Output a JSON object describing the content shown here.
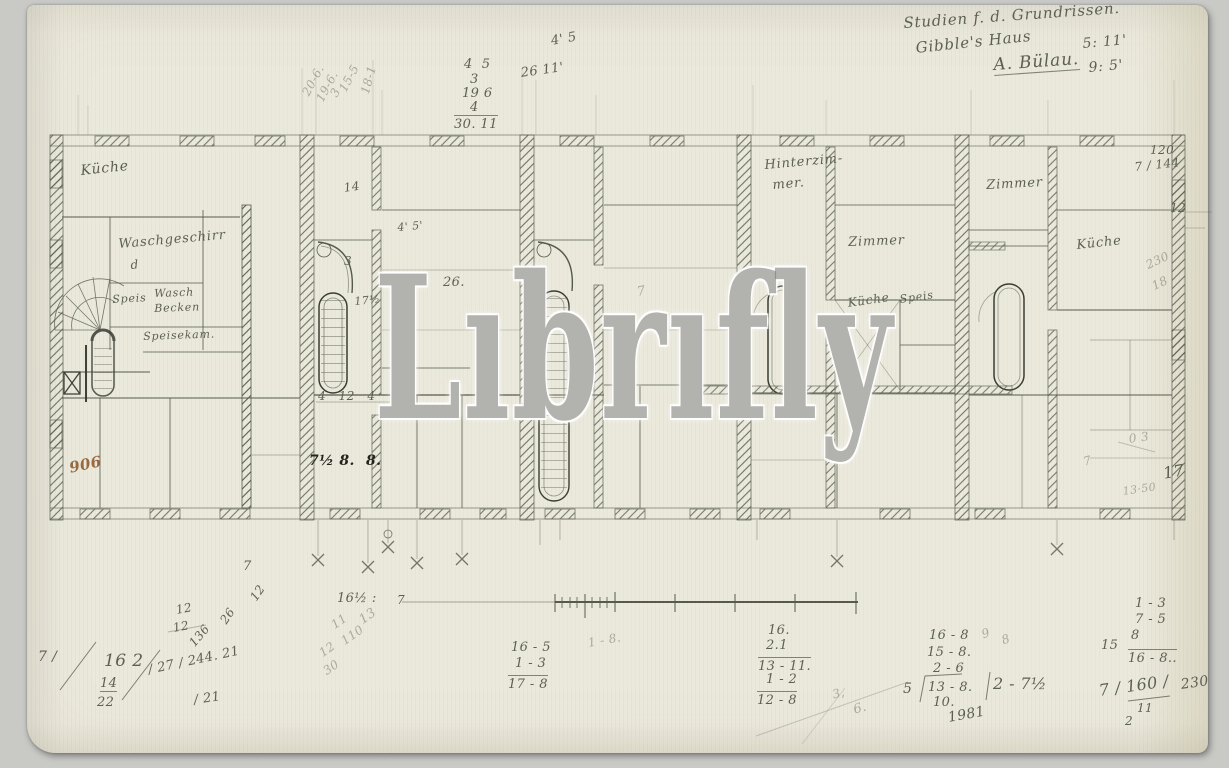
{
  "watermark": {
    "text": "Lıbrıfly"
  },
  "colors": {
    "paper": "#ebe9dc",
    "background": "#c9c9c6",
    "pencil": "#5c6053",
    "dark_ink": "#24241c",
    "sepia_ink": "#8a5426",
    "watermark_gray": "#7a7a75"
  },
  "title_block": {
    "line1": "Studien f. d. Grundrissen.",
    "line2": "Gibble's Haus",
    "dimension_a": "5: 11'",
    "signature": "A. Bülau.",
    "dimension_b": "9: 5'"
  },
  "annotations": [
    {
      "t": "Studien f. d. Grundrissen.",
      "x": 903,
      "y": 16,
      "r": -4,
      "s": 15,
      "c": "script",
      "n": "title-line1"
    },
    {
      "t": "Gibble's Haus",
      "x": 915,
      "y": 41,
      "r": -6,
      "s": 15,
      "c": "script",
      "n": "title-line2"
    },
    {
      "t": "5: 11'",
      "x": 1082,
      "y": 37,
      "r": -5,
      "s": 14,
      "c": "script",
      "n": "title-dimension-a"
    },
    {
      "t": "A. Bülau.",
      "x": 993,
      "y": 57,
      "r": -4,
      "s": 17,
      "c": "script underline",
      "n": "title-signature"
    },
    {
      "t": "9: 5'",
      "x": 1088,
      "y": 61,
      "r": -5,
      "s": 14,
      "c": "script",
      "n": "title-dimension-b"
    },
    {
      "t": "20-6.",
      "x": 300,
      "y": 92,
      "r": -62,
      "s": 12,
      "c": "faint",
      "n": "calc-top-left"
    },
    {
      "t": "19-6.",
      "x": 314,
      "y": 98,
      "r": -62,
      "s": 12,
      "c": "faint"
    },
    {
      "t": "3",
      "x": 328,
      "y": 93,
      "r": -62,
      "s": 12,
      "c": "faint"
    },
    {
      "t": "15-5",
      "x": 337,
      "y": 88,
      "r": -62,
      "s": 12,
      "c": "faint"
    },
    {
      "t": "18-1",
      "x": 359,
      "y": 92,
      "r": -75,
      "s": 12,
      "c": "faint"
    },
    {
      "t": "4  5",
      "x": 464,
      "y": 58,
      "s": 13,
      "n": "calc-top-middle"
    },
    {
      "t": "3",
      "x": 470,
      "y": 73,
      "s": 13
    },
    {
      "t": "19 6",
      "x": 462,
      "y": 87,
      "s": 13
    },
    {
      "t": "4",
      "x": 470,
      "y": 101,
      "s": 13
    },
    {
      "t": "30. 11",
      "x": 454,
      "y": 115,
      "s": 13,
      "c": "sum"
    },
    {
      "t": "26 11'",
      "x": 520,
      "y": 67,
      "r": -8,
      "s": 13
    },
    {
      "t": "4' 5",
      "x": 550,
      "y": 35,
      "r": -10,
      "s": 13
    },
    {
      "t": "Küche",
      "x": 80,
      "y": 164,
      "r": -6,
      "s": 14,
      "c": "script",
      "n": "room-label-kueche-1"
    },
    {
      "t": "Waschgeschirr",
      "x": 118,
      "y": 238,
      "r": -5,
      "s": 13,
      "c": "script",
      "n": "room-label-waschgeschirr"
    },
    {
      "t": "d",
      "x": 130,
      "y": 259,
      "r": -5,
      "s": 12,
      "c": "script"
    },
    {
      "t": "Speis",
      "x": 112,
      "y": 294,
      "r": -3,
      "s": 11,
      "c": "script",
      "n": "room-label-speis-1"
    },
    {
      "t": "Wasch",
      "x": 154,
      "y": 288,
      "r": -2,
      "s": 11,
      "c": "script",
      "n": "room-label-wasch"
    },
    {
      "t": "Becken",
      "x": 154,
      "y": 303,
      "r": -2,
      "s": 11,
      "c": "script"
    },
    {
      "t": "Speisekam.",
      "x": 143,
      "y": 331,
      "r": -2,
      "s": 11,
      "c": "script",
      "n": "room-label-speisekammer"
    },
    {
      "t": "906",
      "x": 68,
      "y": 461,
      "r": -12,
      "s": 15,
      "c": "sepia",
      "n": "number-sepia-906"
    },
    {
      "t": "14",
      "x": 343,
      "y": 182,
      "r": -8,
      "s": 12
    },
    {
      "t": "4' 5'",
      "x": 397,
      "y": 222,
      "r": -5,
      "s": 11
    },
    {
      "t": "3",
      "x": 344,
      "y": 255,
      "s": 12
    },
    {
      "t": "26.",
      "x": 443,
      "y": 276,
      "s": 13
    },
    {
      "t": "17½",
      "x": 354,
      "y": 296,
      "r": -5,
      "s": 11
    },
    {
      "t": "6½",
      "x": 395,
      "y": 357,
      "r": -3,
      "s": 11
    },
    {
      "t": "4   12   4",
      "x": 318,
      "y": 390,
      "s": 12
    },
    {
      "t": "7½ 8.",
      "x": 309,
      "y": 454,
      "s": 14,
      "c": "ink",
      "n": "dim-ink-1"
    },
    {
      "t": "8.",
      "x": 366,
      "y": 454,
      "s": 14,
      "c": "ink",
      "n": "dim-ink-2"
    },
    {
      "t": "7",
      "x": 636,
      "y": 286,
      "r": -10,
      "s": 13,
      "c": "faint"
    },
    {
      "t": "Hinterzim-",
      "x": 764,
      "y": 159,
      "r": -5,
      "s": 13,
      "c": "script",
      "n": "room-label-hinterzimmer"
    },
    {
      "t": "mer.",
      "x": 772,
      "y": 179,
      "r": -5,
      "s": 13,
      "c": "script"
    },
    {
      "t": "Zimmer",
      "x": 848,
      "y": 236,
      "r": -2,
      "s": 13,
      "c": "script",
      "n": "room-label-zimmer-1"
    },
    {
      "t": "Küche",
      "x": 847,
      "y": 297,
      "r": -8,
      "s": 12,
      "c": "script",
      "n": "room-label-kueche-2"
    },
    {
      "t": "Speis",
      "x": 899,
      "y": 294,
      "r": -8,
      "s": 11,
      "c": "script",
      "n": "room-label-speis-2"
    },
    {
      "t": "Zimmer",
      "x": 986,
      "y": 179,
      "r": -3,
      "s": 13,
      "c": "script",
      "n": "room-label-zimmer-2"
    },
    {
      "t": "Küche",
      "x": 1076,
      "y": 239,
      "r": -6,
      "s": 13,
      "c": "script",
      "n": "room-label-kueche-3"
    },
    {
      "t": "120",
      "x": 1150,
      "y": 144,
      "s": 12,
      "n": "margin-number"
    },
    {
      "t": "7 / 144",
      "x": 1134,
      "y": 161,
      "r": -6,
      "s": 12
    },
    {
      "t": "12",
      "x": 1170,
      "y": 202,
      "s": 12
    },
    {
      "t": "230",
      "x": 1144,
      "y": 260,
      "r": -25,
      "s": 12,
      "c": "faint"
    },
    {
      "t": "18",
      "x": 1150,
      "y": 281,
      "r": -25,
      "s": 12,
      "c": "faint"
    },
    {
      "t": "0 3",
      "x": 1128,
      "y": 433,
      "r": -8,
      "s": 12,
      "c": "faint"
    },
    {
      "t": "7",
      "x": 1082,
      "y": 456,
      "r": -15,
      "s": 12,
      "c": "faint"
    },
    {
      "t": "17",
      "x": 1162,
      "y": 466,
      "r": -10,
      "s": 16
    },
    {
      "t": "13·50",
      "x": 1122,
      "y": 486,
      "r": -8,
      "s": 11,
      "c": "faint"
    },
    {
      "t": "7",
      "x": 243,
      "y": 560,
      "s": 13
    },
    {
      "t": "12",
      "x": 248,
      "y": 596,
      "r": -55,
      "s": 12
    },
    {
      "t": "12",
      "x": 175,
      "y": 604,
      "r": -10,
      "s": 12
    },
    {
      "t": "12",
      "x": 172,
      "y": 622,
      "r": -10,
      "s": 12
    },
    {
      "t": "26",
      "x": 218,
      "y": 619,
      "r": -55,
      "s": 12
    },
    {
      "t": "136",
      "x": 187,
      "y": 641,
      "r": -50,
      "s": 12
    },
    {
      "t": "7 /",
      "x": 38,
      "y": 650,
      "s": 14
    },
    {
      "t": "16 2",
      "x": 104,
      "y": 653,
      "s": 17,
      "n": "calc-bottom-left"
    },
    {
      "t": "/ 27 / 244. 21",
      "x": 147,
      "y": 664,
      "r": -12,
      "s": 13
    },
    {
      "t": "14",
      "x": 100,
      "y": 677,
      "s": 13,
      "c": "underline"
    },
    {
      "t": "22",
      "x": 97,
      "y": 696,
      "s": 13
    },
    {
      "t": "/ 21",
      "x": 193,
      "y": 694,
      "r": -8,
      "s": 13
    },
    {
      "t": "16½ :",
      "x": 337,
      "y": 592,
      "s": 13,
      "n": "scale-label"
    },
    {
      "t": "7",
      "x": 397,
      "y": 594,
      "s": 12
    },
    {
      "t": "11",
      "x": 329,
      "y": 621,
      "r": -35,
      "s": 12,
      "c": "faint"
    },
    {
      "t": "13",
      "x": 357,
      "y": 616,
      "r": -35,
      "s": 13,
      "c": "faint"
    },
    {
      "t": "110",
      "x": 339,
      "y": 637,
      "r": -35,
      "s": 12,
      "c": "faint"
    },
    {
      "t": "12",
      "x": 317,
      "y": 649,
      "r": -35,
      "s": 12,
      "c": "faint"
    },
    {
      "t": "30",
      "x": 321,
      "y": 667,
      "r": -35,
      "s": 12,
      "c": "faint"
    },
    {
      "t": "1 - 8.",
      "x": 587,
      "y": 637,
      "r": -10,
      "s": 12,
      "c": "faint"
    },
    {
      "t": "16 - 5",
      "x": 511,
      "y": 641,
      "s": 13,
      "n": "calc-bottom-mid"
    },
    {
      "t": "1 - 3",
      "x": 515,
      "y": 657,
      "s": 13
    },
    {
      "t": "17 - 8",
      "x": 508,
      "y": 675,
      "s": 13,
      "c": "sum"
    },
    {
      "t": "16.",
      "x": 768,
      "y": 624,
      "s": 13,
      "n": "calc-bottom-center"
    },
    {
      "t": "2.1",
      "x": 766,
      "y": 639,
      "s": 13
    },
    {
      "t": "13 - 11.",
      "x": 758,
      "y": 657,
      "s": 13,
      "c": "sum"
    },
    {
      "t": "1 - 2",
      "x": 766,
      "y": 673,
      "s": 13
    },
    {
      "t": "12 - 8",
      "x": 757,
      "y": 691,
      "s": 13,
      "c": "sum"
    },
    {
      "t": "16 - 8",
      "x": 929,
      "y": 629,
      "s": 13,
      "n": "calc-bottom-right"
    },
    {
      "t": "15 - 8.",
      "x": 927,
      "y": 646,
      "s": 13
    },
    {
      "t": "2 - 6",
      "x": 933,
      "y": 662,
      "s": 13
    },
    {
      "t": "5",
      "x": 903,
      "y": 682,
      "s": 14
    },
    {
      "t": "13 - 8.",
      "x": 928,
      "y": 681,
      "s": 13
    },
    {
      "t": "10.",
      "x": 933,
      "y": 696,
      "s": 13
    },
    {
      "t": "2 - 7½",
      "x": 993,
      "y": 676,
      "s": 16,
      "n": "result-highlight"
    },
    {
      "t": "1981",
      "x": 947,
      "y": 711,
      "r": -10,
      "s": 14
    },
    {
      "t": "9",
      "x": 980,
      "y": 629,
      "r": -20,
      "s": 12,
      "c": "faint"
    },
    {
      "t": "8",
      "x": 1000,
      "y": 635,
      "r": -20,
      "s": 12,
      "c": "faint"
    },
    {
      "t": "3,",
      "x": 831,
      "y": 689,
      "r": -15,
      "s": 12,
      "c": "faint"
    },
    {
      "t": "6.",
      "x": 852,
      "y": 704,
      "r": -15,
      "s": 13,
      "c": "faint"
    },
    {
      "t": "1 - 3",
      "x": 1135,
      "y": 597,
      "s": 13,
      "n": "calc-far-right"
    },
    {
      "t": "7 - 5",
      "x": 1135,
      "y": 613,
      "s": 13
    },
    {
      "t": "8",
      "x": 1131,
      "y": 629,
      "s": 13
    },
    {
      "t": "15",
      "x": 1101,
      "y": 639,
      "s": 13
    },
    {
      "t": "16 - 8..",
      "x": 1128,
      "y": 649,
      "s": 13,
      "c": "sum"
    },
    {
      "t": "7 / 160 /",
      "x": 1098,
      "y": 683,
      "r": -8,
      "s": 16
    },
    {
      "t": "230",
      "x": 1180,
      "y": 678,
      "r": -8,
      "s": 14
    },
    {
      "t": "11",
      "x": 1137,
      "y": 702,
      "s": 12
    },
    {
      "t": "2",
      "x": 1125,
      "y": 715,
      "s": 12
    }
  ]
}
